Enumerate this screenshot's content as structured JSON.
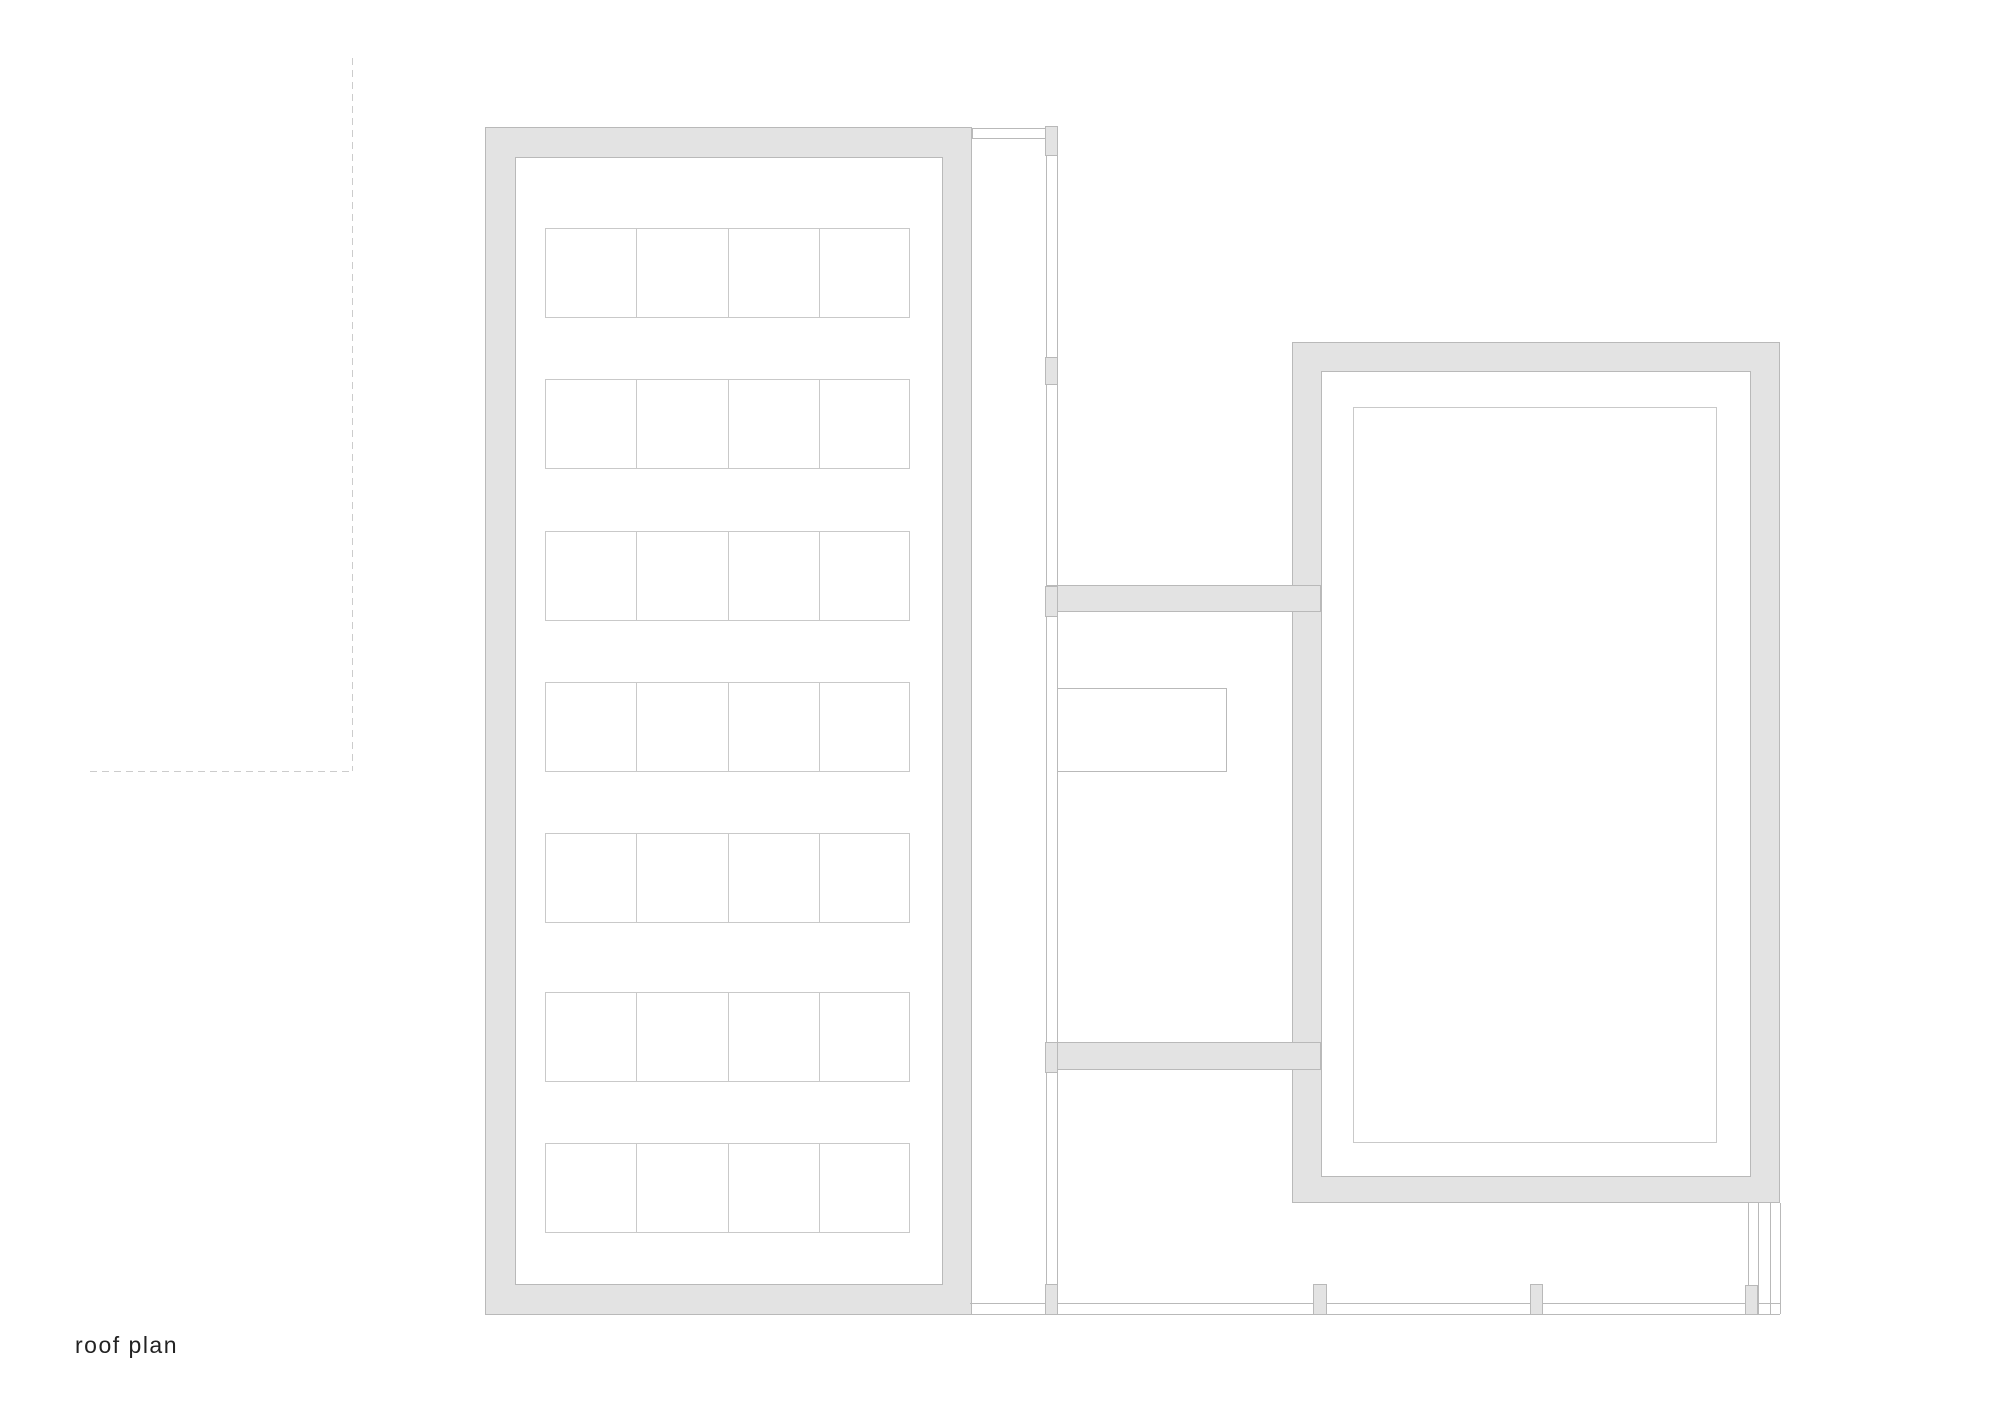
{
  "title_label": "roof plan",
  "colors": {
    "background": "#ffffff",
    "wall_fill": "#e3e3e3",
    "wall_line": "#b9b9b9",
    "thin_line": "#c9c9c9",
    "dashed_line": "#cccccc",
    "label_text": "#222222"
  },
  "canvas": {
    "width": 2000,
    "height": 1413
  },
  "plan": {
    "site_boundary": [
      {
        "name": "site-boundary-dashed-vertical",
        "type": "vdash",
        "x": 352,
        "y1": 58,
        "y2": 771
      },
      {
        "name": "site-boundary-dashed-horizontal",
        "type": "hdash",
        "y": 771,
        "x1": 90,
        "x2": 352
      }
    ],
    "left_hall": {
      "outer": {
        "x1": 485,
        "y1": 127,
        "x2": 972,
        "y2": 1315
      },
      "inner": {
        "x1": 515,
        "y1": 157,
        "x2": 943,
        "y2": 1285
      },
      "skylights": {
        "x": 545,
        "width": 365,
        "cols": 4,
        "row_height": 90,
        "row_tops": [
          228,
          379,
          531,
          682,
          833,
          992,
          1143
        ]
      }
    },
    "right_hall": {
      "outer": {
        "x1": 1292,
        "y1": 342,
        "x2": 1780,
        "y2": 1203
      },
      "inner": {
        "x1": 1321,
        "y1": 371,
        "x2": 1751,
        "y2": 1177
      },
      "rooflight": {
        "x1": 1353,
        "y1": 407,
        "x2": 1717,
        "y2": 1143
      }
    },
    "connector": {
      "top_band": {
        "x1": 972,
        "y1": 128,
        "x2": 1046,
        "y2": 139
      },
      "wall_lines_x": [
        1046,
        1057
      ],
      "wall_lines_y": {
        "y1": 127,
        "y2": 1315
      },
      "cross_walls": [
        {
          "name": "cross-wall-upper",
          "x1": 1046,
          "y1": 585,
          "x2": 1321,
          "y2": 612
        },
        {
          "name": "cross-wall-lower",
          "x1": 1046,
          "y1": 1042,
          "x2": 1321,
          "y2": 1070
        }
      ],
      "hatch": {
        "x1": 1057,
        "y1": 688,
        "x2": 1227,
        "y2": 772
      }
    },
    "terrace": {
      "edge_lines_y": [
        1303,
        1314
      ],
      "x1": 970,
      "x2": 1780,
      "right_lines_x": [
        1748,
        1758,
        1770,
        1780
      ],
      "right_lines_y": {
        "y1": 1203,
        "y2": 1314
      },
      "piers": [
        {
          "name": "corridor-pier-top",
          "x1": 1045,
          "y1": 126,
          "x2": 1058,
          "y2": 156
        },
        {
          "name": "corridor-pier-upper",
          "x1": 1045,
          "y1": 357,
          "x2": 1058,
          "y2": 385
        },
        {
          "name": "corridor-pier-crosswall",
          "x1": 1045,
          "y1": 586,
          "x2": 1058,
          "y2": 617
        },
        {
          "name": "corridor-pier-lower",
          "x1": 1045,
          "y1": 1042,
          "x2": 1058,
          "y2": 1073
        },
        {
          "name": "terrace-pier-1",
          "x1": 1045,
          "y1": 1284,
          "x2": 1058,
          "y2": 1315
        },
        {
          "name": "terrace-pier-2",
          "x1": 1313,
          "y1": 1284,
          "x2": 1327,
          "y2": 1315
        },
        {
          "name": "terrace-pier-3",
          "x1": 1530,
          "y1": 1284,
          "x2": 1543,
          "y2": 1315
        },
        {
          "name": "terrace-pier-4",
          "x1": 1745,
          "y1": 1285,
          "x2": 1758,
          "y2": 1315
        }
      ]
    }
  },
  "label": {
    "x": 75,
    "y": 1332
  }
}
